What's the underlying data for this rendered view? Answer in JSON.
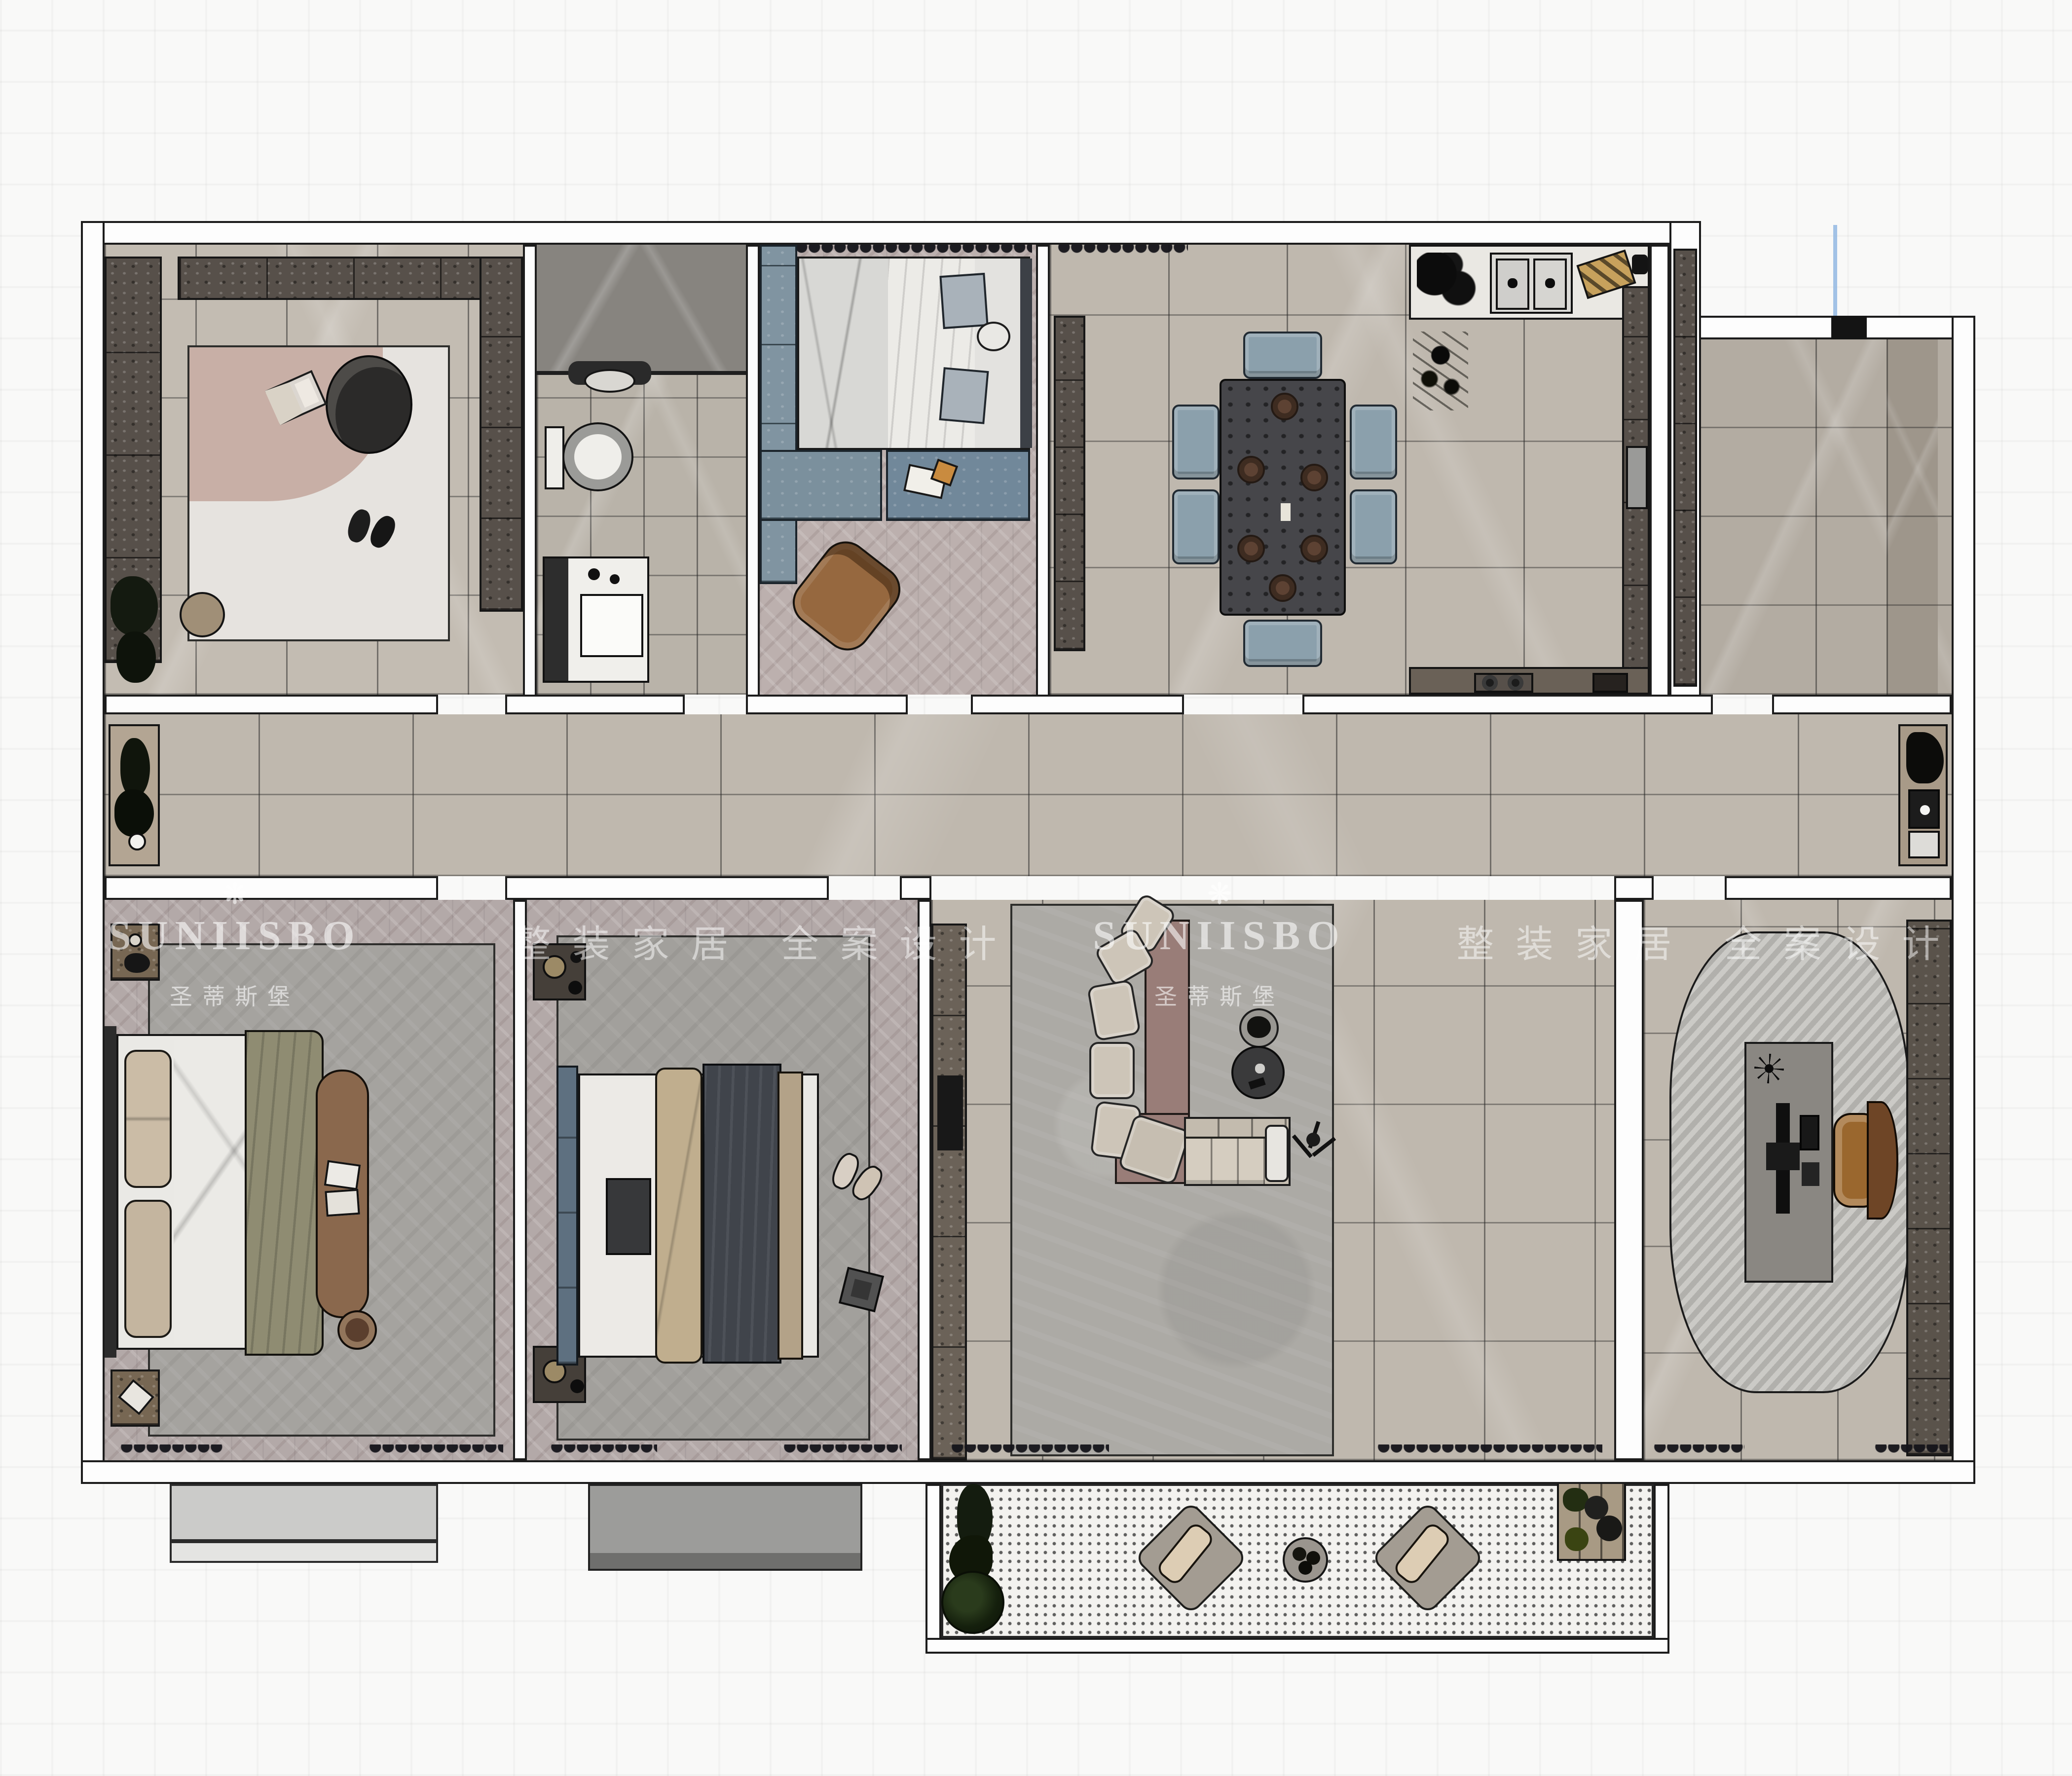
{
  "watermarks": {
    "brand": "SUNIISBO",
    "brand_cn": "圣蒂斯堡",
    "slogan_cn": "整装家居 全案设计",
    "flower_icon": "❋"
  },
  "palette": {
    "background": "#f9f9f8",
    "wall_fill": "#fdfdfd",
    "outline": "#1c1c1c",
    "floor_tile": "#bfb8ae",
    "floor_herringbone": "#b3a9a8",
    "cabinet_dark_wood": "#57504a",
    "cabinet_blue_gray": "#8094a1",
    "dining_chair": "#8ba0ac",
    "sofa_beige": "#cdc5b8",
    "sofa_platform_mauve": "#997d78",
    "rug_gray": "#a8a6a2",
    "bed_blanket_olive": "#8f8c72",
    "bed_blanket_navy": "#40444b",
    "wood_chair_brown": "#8a5a36",
    "balcony_dots": "#f3f2ef",
    "guide_line_blue": "#9fc3e8"
  }
}
